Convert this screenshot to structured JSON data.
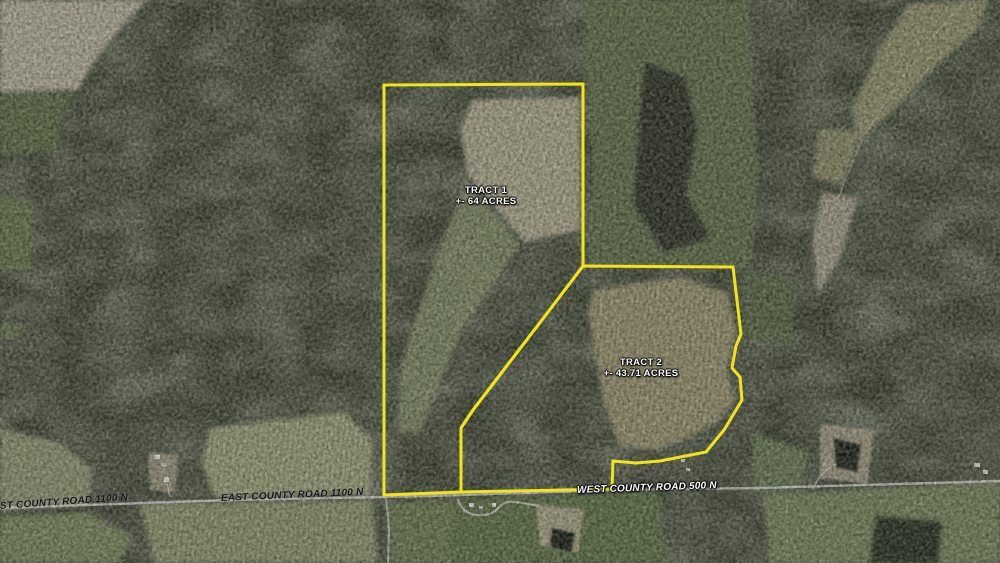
{
  "map": {
    "description": "Aerial land-auction map with two outlined tracts",
    "tracts": [
      {
        "name": "TRACT 1",
        "acres": "+- 64 ACRES"
      },
      {
        "name": "TRACT 2",
        "acres": "+- 43.71 ACRES"
      }
    ],
    "road_labels": {
      "west_edge": "ST COUNTY ROAD 1100 N",
      "center": "EAST COUNTY ROAD 1100 N",
      "east": "WEST COUNTY ROAD 500 N"
    },
    "colors": {
      "tract_boundary": "#f2e41a",
      "tract_label_text": "#ffffff",
      "road_label_dark": "#16181c",
      "road_label_light": "#ffffff",
      "forest_base": "#3b422f",
      "field_tan": "#a7a287",
      "pasture_green": "#5e6d49",
      "road_surface": "#cfcfc9"
    }
  }
}
